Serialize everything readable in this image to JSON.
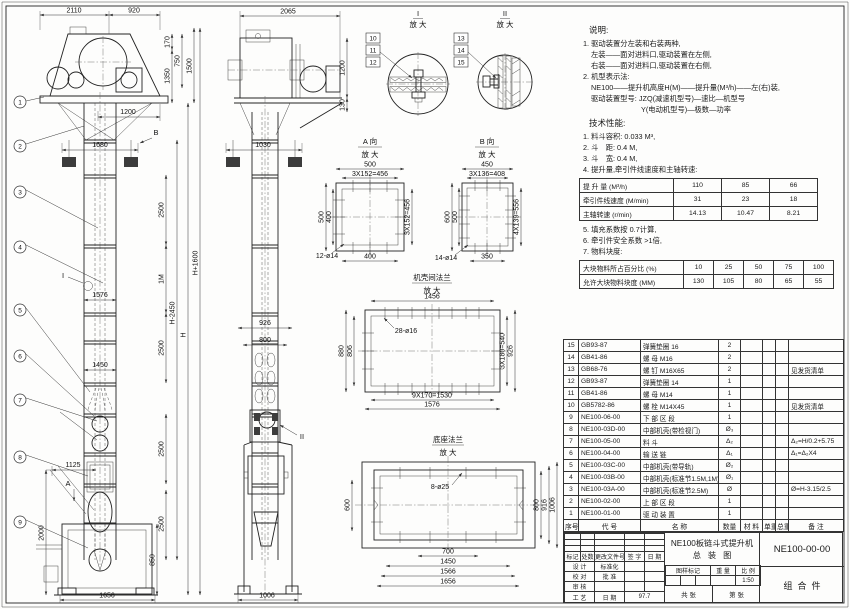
{
  "d": {
    "m2110": "2110",
    "m920": "920",
    "m170": "170",
    "m750": "750",
    "m1350": "1350",
    "m1500": "1500",
    "m1200": "1200",
    "m1680": "1680",
    "m1576": "1576",
    "m1450": "1450",
    "m1125": "1125",
    "m2000": "2000",
    "m850": "850",
    "m1656": "1656",
    "m2500": "2500",
    "m1m": "1M",
    "mh": "H",
    "mhm": "H-2450",
    "mhp": "H+1600",
    "s2065": "2065",
    "s1200": "1200",
    "s130": "130",
    "s1030": "1030",
    "s926": "926",
    "s800": "800",
    "s1006": "1006",
    "a500": "500",
    "a456": "3X152=456",
    "a400": "400",
    "a12": "12-ø14",
    "b450": "450",
    "b408": "3X136=408",
    "b600": "600",
    "b500": "500",
    "b350": "350",
    "b556": "4X139=556",
    "b14": "14-ø14",
    "f1456": "1456",
    "f28": "28-ø16",
    "f880": "880",
    "f806": "806",
    "f540": "3X180=540",
    "f926": "926",
    "f1530": "9X170=1530",
    "f1576": "1576",
    "g8": "8-ø25",
    "g600": "600",
    "g800": "800",
    "g916": "916",
    "g1006": "1006",
    "g700": "700",
    "g1450": "1450",
    "g1566": "1566",
    "g1656": "1656"
  },
  "bal": {
    "b1": "1",
    "b2": "2",
    "b3": "3",
    "b4": "4",
    "b5": "5",
    "b6": "6",
    "b7": "7",
    "b8": "8",
    "b9": "9",
    "b10": "10",
    "b11": "11",
    "b12": "12",
    "b13": "13",
    "b14": "14",
    "b15": "15"
  },
  "mk": {
    "a": "A",
    "b": "B",
    "i": "I",
    "ii": "II"
  },
  "lbl": {
    "zoom": "放 大",
    "va": "A 向",
    "vb": "B 向",
    "flange": "机壳间法兰",
    "base": "底座法兰"
  },
  "notes": {
    "heading": "说明:",
    "n1": "1. 驱动装置分左装和右装两种,",
    "n1a": "左装——面对进料口,驱动装置在左侧,",
    "n1b": "右装——面对进料口,驱动装置在右侧,",
    "n2": "2. 机型表示法:",
    "n2a": "NE100——提升机高度H(M)——提升量(M³/h)——左(右)装,",
    "n2b": "驱动装置型号: JZQ(减速机型号)—速比—机型号",
    "n2c": "Y(电动机型号)—极数—功率",
    "tech_heading": "技术性能:",
    "t1": "1. 料斗容积: 0.033 M³,",
    "t2": "2. 斗　距: 0.4 M,",
    "t3": "3. 斗　宽: 0.4 M,",
    "t4": "4. 提升量,牵引件线速度和主轴转速:",
    "t5": "5. 填充系数按 0.7计算,",
    "t6": "6. 牵引件安全系数 >1倍,",
    "t7": "7. 物料块度:"
  },
  "perf_table": {
    "rows": [
      [
        "提 升 量  (M³/h)",
        "110",
        "85",
        "66"
      ],
      [
        "牵引件线速度 (M/min)",
        "31",
        "23",
        "18"
      ],
      [
        "主轴转速 (r/min)",
        "14.13",
        "10.47",
        "8.21"
      ]
    ]
  },
  "lump_table": {
    "rows": [
      [
        "大块物料所占百分比 (%)",
        "10",
        "25",
        "50",
        "75",
        "100"
      ],
      [
        "允许大块物料块度 (MM)",
        "130",
        "105",
        "80",
        "65",
        "55"
      ]
    ]
  },
  "bom": {
    "headers": [
      "序号",
      "代  号",
      "名  称",
      "数量",
      "材 料",
      "单重",
      "总重",
      "备 注"
    ],
    "rows": [
      [
        "15",
        "GB93-87",
        "弹簧垫圈 16",
        "2",
        "",
        "",
        "",
        ""
      ],
      [
        "14",
        "GB41-86",
        "螺 母 M16",
        "2",
        "",
        "",
        "",
        ""
      ],
      [
        "13",
        "GB68-76",
        "螺 钉 M16X65",
        "2",
        "",
        "",
        "",
        "见发货清单"
      ],
      [
        "12",
        "GB93-87",
        "弹簧垫圈 14",
        "1",
        "",
        "",
        "",
        ""
      ],
      [
        "11",
        "GB41-86",
        "螺 母 M14",
        "1",
        "",
        "",
        "",
        ""
      ],
      [
        "10",
        "GB5782-86",
        "螺 栓 M14X45",
        "1",
        "",
        "",
        "",
        "见发货清单"
      ],
      [
        "9",
        "NE100-06-00",
        "下 部 区 段",
        "1",
        "",
        "",
        "",
        ""
      ],
      [
        "8",
        "NE100-03D-00",
        "中部机壳(带检视门)",
        "Ø₃",
        "",
        "",
        "",
        ""
      ],
      [
        "7",
        "NE100-05-00",
        "料 斗",
        "Δ₂",
        "",
        "",
        "",
        "Δ₂=H/0.2+5.75"
      ],
      [
        "6",
        "NE100-04-00",
        "输 送 链",
        "Δ₁",
        "",
        "",
        "",
        "Δ₁=Δ₂X4"
      ],
      [
        "5",
        "NE100-03C-00",
        "中部机壳(带导轨)",
        "Ø₂",
        "",
        "",
        "",
        ""
      ],
      [
        "4",
        "NE100-03B-00",
        "中部机壳(标准节1.5M,1M)",
        "Ø₁",
        "",
        "",
        "",
        ""
      ],
      [
        "3",
        "NE100-03A-00",
        "中部机壳(标准节2.5M)",
        "Ø",
        "",
        "",
        "",
        "Ø=H-3.15/2.5"
      ],
      [
        "2",
        "NE100-02-00",
        "上 部 区 段",
        "1",
        "",
        "",
        "",
        ""
      ],
      [
        "1",
        "NE100-01-00",
        "驱 动 装 置",
        "1",
        "",
        "",
        "",
        ""
      ]
    ]
  },
  "tb": {
    "rev_headers": [
      "标记",
      "处数",
      "更改文件号",
      "签 字",
      "日 期"
    ],
    "r1l": "设 计",
    "r1r": "标准化",
    "r2l": "校 对",
    "r2r": "批 准",
    "r3l": "审 核",
    "r3r": "",
    "r4l": "工 艺",
    "r4r": "日 期",
    "date": "97.7",
    "title1": "NE100板链斗式提升机",
    "title2": "总装图",
    "mark": "图样标记",
    "weight": "重 量",
    "scale_label": "比 例",
    "scale": "1:50",
    "sheet1": "共  张",
    "sheet2": "第  张",
    "code": "NE100-00-00",
    "type": "组合件"
  }
}
